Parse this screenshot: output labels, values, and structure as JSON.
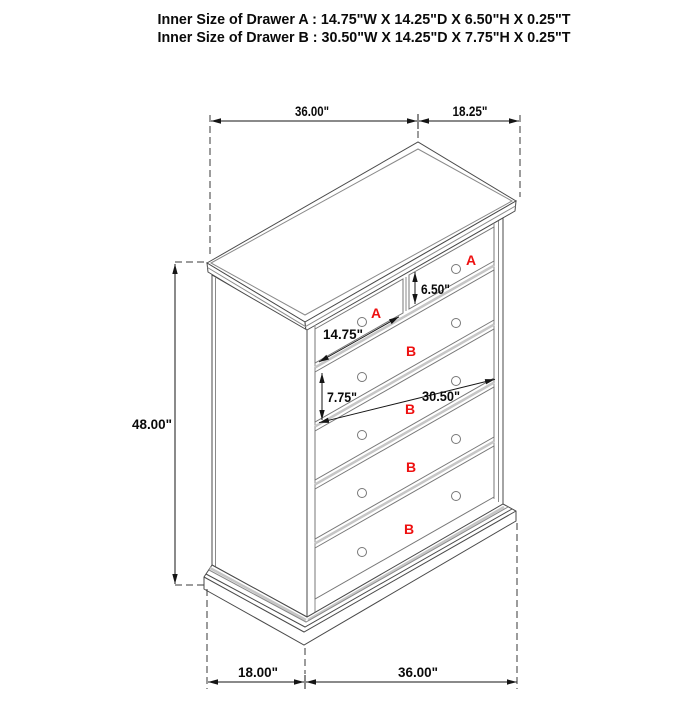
{
  "title": {
    "line_a": "Inner Size of Drawer A : 14.75\"W X 14.25\"D X 6.50\"H X 0.25\"T",
    "line_b": "Inner Size of Drawer B : 30.50\"W X 14.25\"D X 7.75\"H X 0.25\"T"
  },
  "dimensions": {
    "top_width": "36.00\"",
    "top_depth": "18.25\"",
    "height": "48.00\"",
    "bottom_depth": "18.00\"",
    "bottom_width": "36.00\"",
    "drawer_a_height": "6.50\"",
    "drawer_a_width": "14.75\"",
    "drawer_b_height": "7.75\"",
    "drawer_b_width": "30.50\""
  },
  "drawers": {
    "top_left_label": "A",
    "top_right_label": "A",
    "row1_label": "B",
    "row2_label": "B",
    "row3_label": "B",
    "row4_label": "B"
  },
  "colors": {
    "drawer_label": "#ee1010",
    "dimension_text": "#0a0a0a",
    "outline": "#4a4a4a",
    "background": "#ffffff"
  }
}
